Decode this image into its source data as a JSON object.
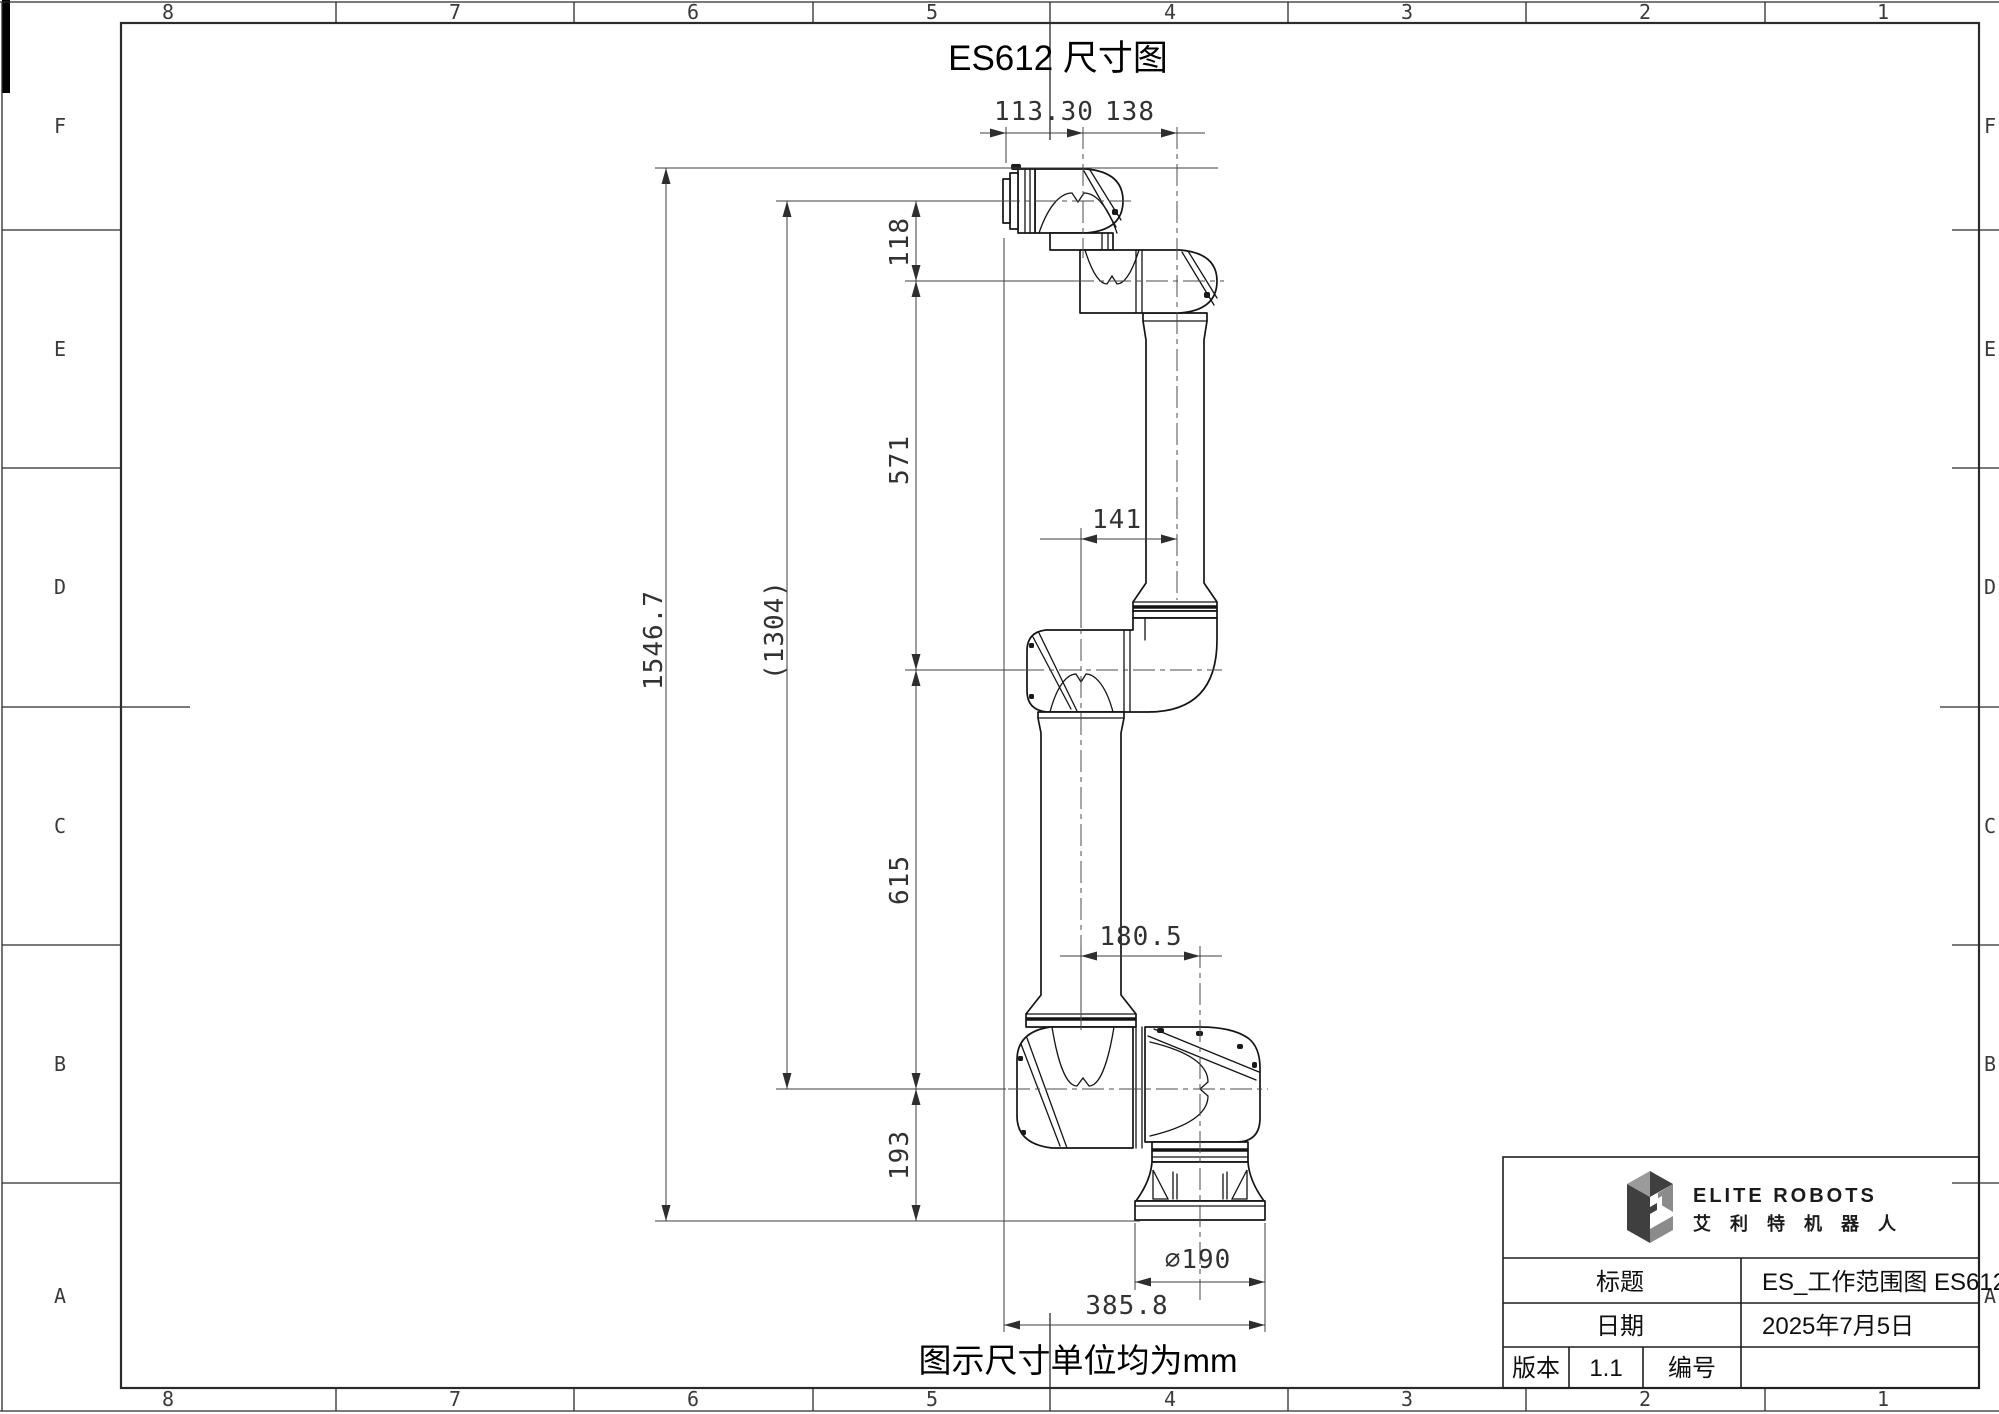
{
  "sheet": {
    "title": "ES612 尺寸图",
    "note": "图示尺寸单位均为mm",
    "frame": {
      "cols": [
        "8",
        "7",
        "6",
        "5",
        "4",
        "3",
        "2",
        "1"
      ],
      "rows": [
        "F",
        "E",
        "D",
        "C",
        "B",
        "A"
      ]
    },
    "dimensions": {
      "overall_height": "1546.7",
      "reach_ref": "(1304)",
      "seg_top": "118",
      "seg_forearm": "571",
      "seg_upperarm": "615",
      "seg_base": "193",
      "top_left": "113.30",
      "top_right": "138",
      "elbow_offset": "141",
      "shoulder_offset": "180.5",
      "base_diameter": "∅190",
      "overall_width": "385.8"
    },
    "title_block": {
      "brand": "ELITE ROBOTS",
      "brand_cn": "艾 利 特 机 器 人",
      "title_label": "标题",
      "title_value": "ES_工作范围图  ES612",
      "date_label": "日期",
      "date_value": "2025年7月5日",
      "version_label": "版本",
      "version_value": "1.1",
      "number_label": "编号",
      "number_value": ""
    },
    "colors": {
      "line": "#1c1c1c",
      "dim_text": "#323232",
      "logo_dark": "#3f3f3f",
      "logo_light": "#9a9a9a"
    }
  }
}
